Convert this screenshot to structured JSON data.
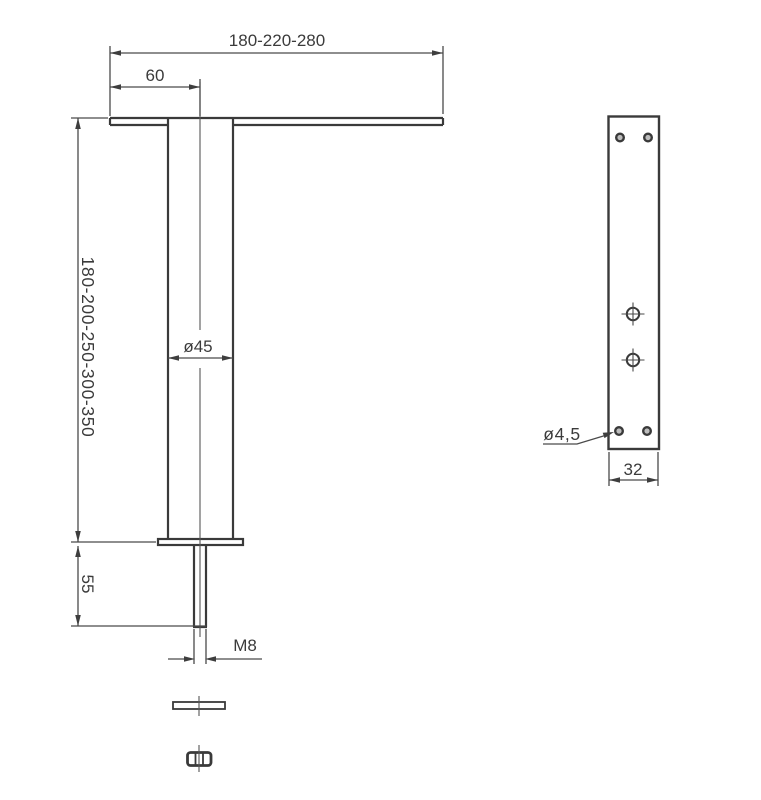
{
  "drawing": {
    "type": "technical-drawing",
    "views": [
      "front-view",
      "side-view"
    ],
    "colors": {
      "line": "#3a3a3a",
      "dimension_line": "#4a4a4a",
      "background": "#ffffff"
    },
    "labels": {
      "top_width": "180-220-280",
      "plate_offset": "60",
      "leg_height": "180-200-250-300-350",
      "tube_diameter": "ø45",
      "stud_length": "55",
      "thread": "M8",
      "hole_diameter": "ø4,5",
      "plate_width": "32"
    }
  }
}
